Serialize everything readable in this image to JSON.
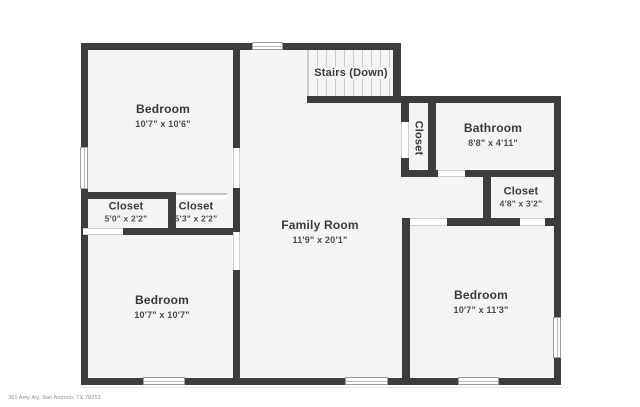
{
  "plan_title": "First floor plan",
  "rooms": {
    "bedroom_tl": {
      "name": "Bedroom",
      "dims": "10'7\" x 10'6\""
    },
    "closet_a": {
      "name": "Closet",
      "dims": "5'0\" x 2'2\""
    },
    "closet_b": {
      "name": "Closet",
      "dims": "5'3\" x 2'2\""
    },
    "bedroom_bl": {
      "name": "Bedroom",
      "dims": "10'7\" x 10'7\""
    },
    "family": {
      "name": "Family Room",
      "dims": "11'9\" x 20'1\""
    },
    "stairs": {
      "name": "Stairs (Down)"
    },
    "hall_closet": {
      "name": "Closet"
    },
    "bathroom": {
      "name": "Bathroom",
      "dims": "8'8\" x 4'11\""
    },
    "closet_hall": {
      "name": "Closet",
      "dims": "4'8\" x 3'2\""
    },
    "bedroom_br": {
      "name": "Bedroom",
      "dims": "10'7\" x 11'3\""
    }
  },
  "footer": {
    "address": "361 Amy Aly, San Antonio, TX 78253"
  },
  "colors": {
    "wall": "#3d3d3d",
    "floor": "#f4f4f5",
    "tread": "#c9c9c9",
    "window_frame": "#9c9c9c",
    "text": "#3a3a3a"
  }
}
